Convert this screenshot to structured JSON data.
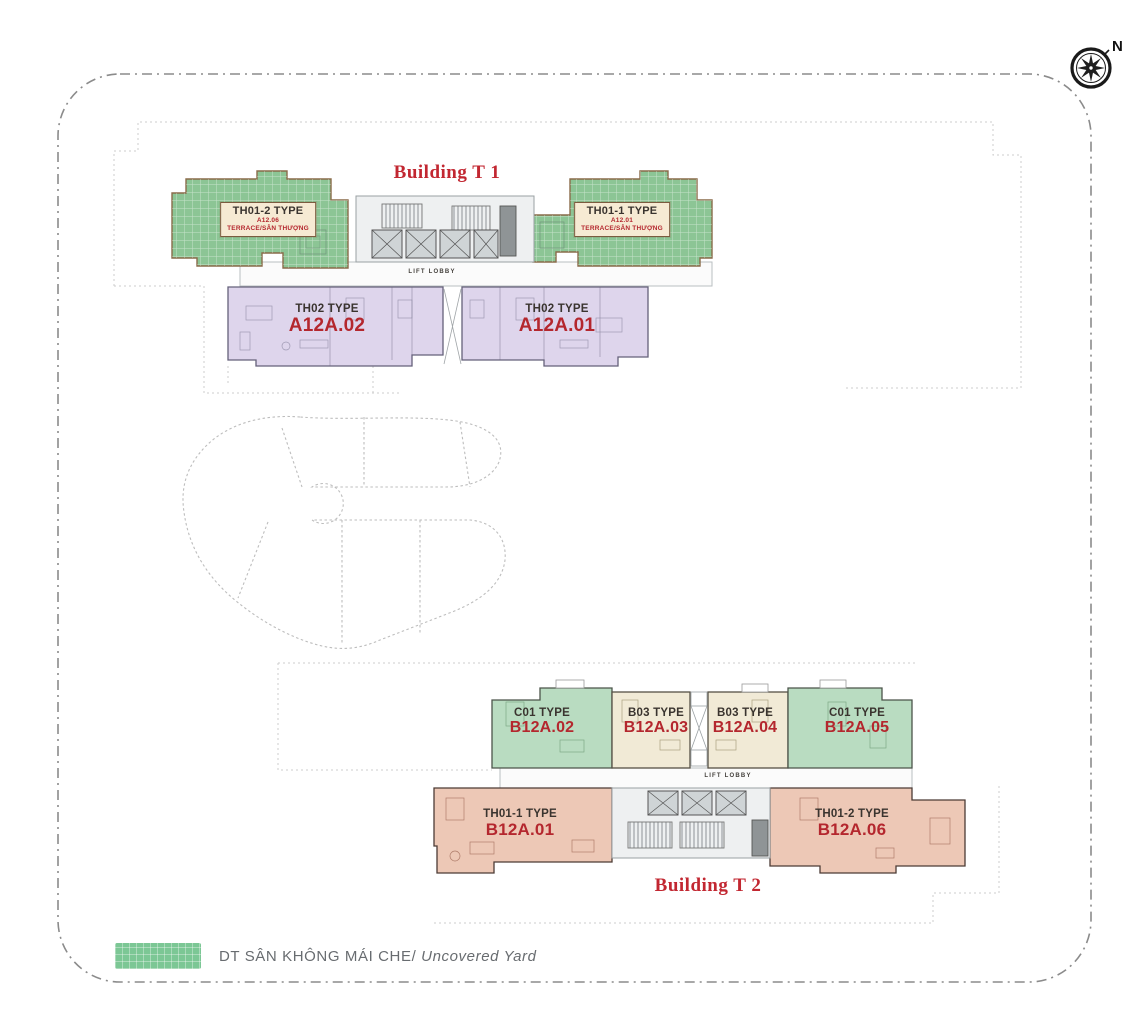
{
  "compass": {
    "north_label": "N"
  },
  "buildings": {
    "t1": {
      "title": "Building T 1",
      "lift_lobby": "LIFT LOBBY",
      "units": [
        {
          "type_label": "TH01-2 TYPE",
          "code": "A12.06",
          "subtitle": "TERRACE/SÂN THƯỢNG"
        },
        {
          "type_label": "TH01-1 TYPE",
          "code": "A12.01",
          "subtitle": "TERRACE/SÂN THƯỢNG"
        },
        {
          "type_label": "TH02 TYPE",
          "code": "A12A.02"
        },
        {
          "type_label": "TH02 TYPE",
          "code": "A12A.01"
        }
      ]
    },
    "t2": {
      "title": "Building T 2",
      "lift_lobby": "LIFT LOBBY",
      "units": [
        {
          "type_label": "C01 TYPE",
          "code": "B12A.02"
        },
        {
          "type_label": "B03 TYPE",
          "code": "B12A.03"
        },
        {
          "type_label": "B03 TYPE",
          "code": "B12A.04"
        },
        {
          "type_label": "C01 TYPE",
          "code": "B12A.05"
        },
        {
          "type_label": "TH01-1 TYPE",
          "code": "B12A.01"
        },
        {
          "type_label": "TH01-2 TYPE",
          "code": "B12A.06"
        }
      ]
    }
  },
  "legend": {
    "uncovered_yard": {
      "label_vi": "DT SÂN KHÔNG MÁI CHE/",
      "label_en": "Uncovered Yard",
      "swatch_color": "#7cc795"
    }
  },
  "colors": {
    "accent_red": "#b4272e",
    "title_red": "#c22731",
    "terrace_green": "#8cc595",
    "unit_green": "#b9dcc1",
    "unit_cream": "#f1ead6",
    "unit_purple": "#ded5ec",
    "unit_salmon": "#edc8b6",
    "legend_green": "#7cc795",
    "boundary_gray": "#8b8b8b"
  }
}
